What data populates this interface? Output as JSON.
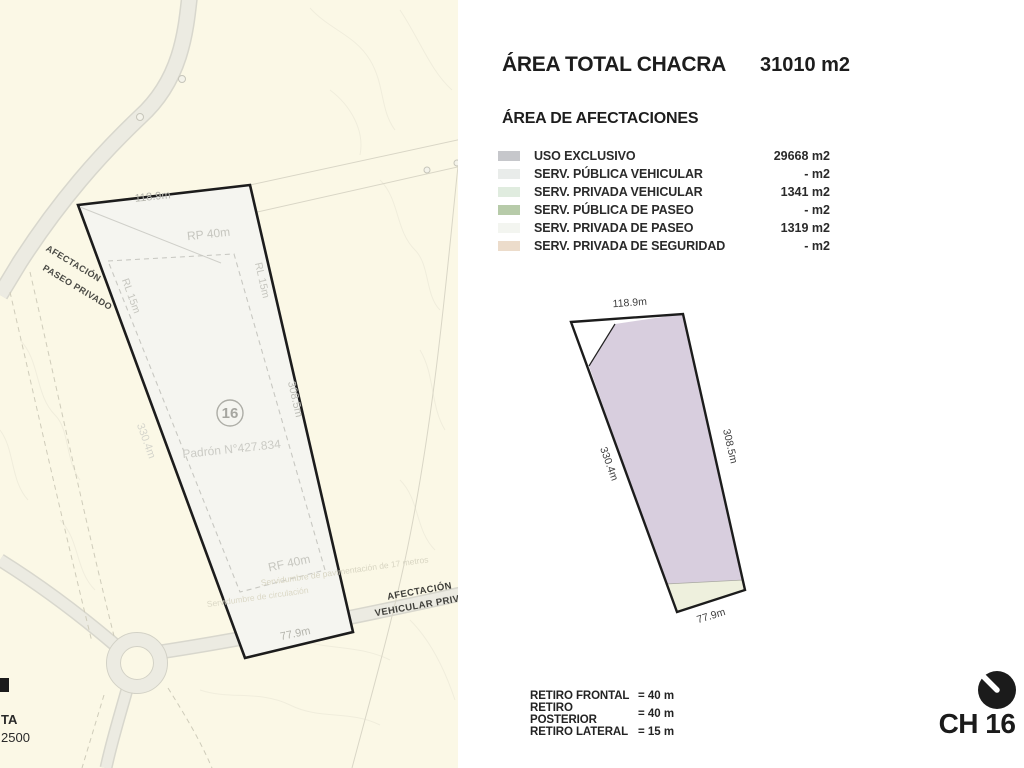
{
  "panel": {
    "title": "ÁREA TOTAL CHACRA",
    "title_value": "31010 m2",
    "legend_title": "ÁREA DE AFECTACIONES",
    "legend": [
      {
        "label": "USO EXCLUSIVO",
        "value": "29668 m2",
        "color": "#c6c7cb"
      },
      {
        "label": "SERV. PÚBLICA VEHICULAR",
        "value": "- m2",
        "color": "#e9ecea"
      },
      {
        "label": "SERV. PRIVADA VEHICULAR",
        "value": "1341 m2",
        "color": "#e0ecdf"
      },
      {
        "label": "SERV. PÚBLICA DE PASEO",
        "value": "- m2",
        "color": "#b7cba9"
      },
      {
        "label": "SERV. PRIVADA DE PASEO",
        "value": "1319 m2",
        "color": "#f3f5f0"
      },
      {
        "label": "SERV. PRIVADA DE SEGURIDAD",
        "value": "- m2",
        "color": "#ecdccb"
      }
    ],
    "retiros": [
      {
        "label": "RETIRO FRONTAL",
        "value": "= 40 m"
      },
      {
        "label": "RETIRO POSTERIOR",
        "value": "= 40 m"
      },
      {
        "label": "RETIRO LATERAL",
        "value": "= 15 m"
      }
    ],
    "diagram": {
      "top": "118.9m",
      "right": "308.5m",
      "left": "330.4m",
      "bottom": "77.9m",
      "fill": "#d8cede",
      "strip_fill": "#eef0dd"
    }
  },
  "map": {
    "measurements": {
      "top": "118.9m",
      "bottom": "77.9m",
      "right": "308.5m",
      "left": "330.4m"
    },
    "setbacks": {
      "rp": "RP 40m",
      "rf": "RF 40m",
      "rl_left": "RL 15m",
      "rl_right": "RL 15m"
    },
    "parcel_number": "16",
    "padron": "Padrón N°427.834",
    "afectacion_paseo_line1": "AFECTACIÓN",
    "afectacion_paseo_line2": "PASEO PRIVADO",
    "afectacion_vehicular_line1": "AFECTACIÓN",
    "afectacion_vehicular_line2": "VEHICULAR PRIVADA",
    "servidumbre_a": "Servidumbre de pavimentación de 17 metros",
    "servidumbre_b": "Servidumbre de circulación",
    "corner_label": "TA",
    "corner_scale": "2500"
  },
  "brand": {
    "text": "CH 16"
  }
}
